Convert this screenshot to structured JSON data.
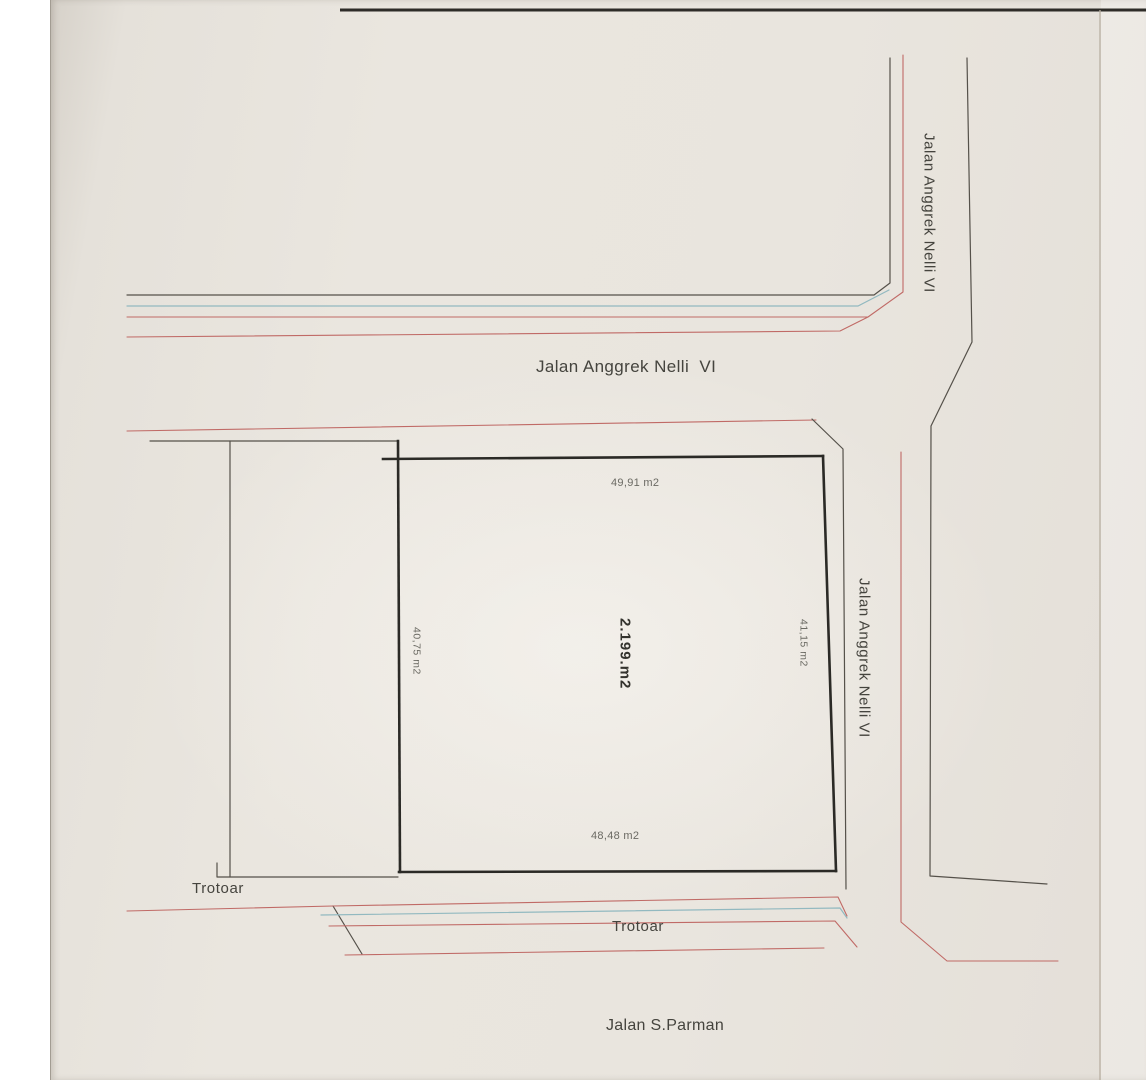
{
  "labels": {
    "street_top_vertical": "Jalan Anggrek Nelli VI",
    "street_horizontal": "Jalan Anggrek Nelli  VI",
    "street_right_vertical": "Jalan Anggrek Nelli VI",
    "street_bottom": "Jalan S.Parman",
    "sidewalk_left": "Trotoar",
    "sidewalk_bottom": "Trotoar"
  },
  "parcel": {
    "area_total": "2.199.m2",
    "edge_top": "49,91 m2",
    "edge_left": "40,75 m2",
    "edge_right": "41,15 m2",
    "edge_bottom": "48,48 m2"
  },
  "colors": {
    "line_dark": "#55514a",
    "line_thick": "#2b2a26",
    "line_red": "#c06a66",
    "line_blue": "#92b9c0",
    "text": "#45443e",
    "text_faint": "#6b6a63",
    "paper": "#e8e4dd"
  }
}
